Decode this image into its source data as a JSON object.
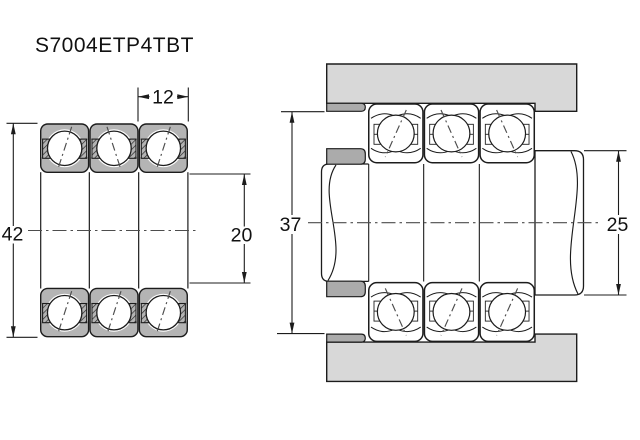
{
  "title": "S7004ETP4TBT",
  "left_view": {
    "description": "Triplex bearing set cross-section",
    "dims": {
      "outer_diameter": "42",
      "single_width": "12",
      "bore_diameter": "20"
    }
  },
  "right_view": {
    "description": "Mounted arrangement with shaft and housing",
    "dims": {
      "housing_shoulder_diameter": "37",
      "shaft_shoulder_diameter": "25"
    }
  },
  "colors": {
    "background": "#ffffff",
    "line": "#1c1c1c",
    "bearing_fill": "#b4b4b4",
    "housing_fill": "#d8d8d8",
    "spacer_fill": "#ababab",
    "dim_text": "#111111"
  }
}
